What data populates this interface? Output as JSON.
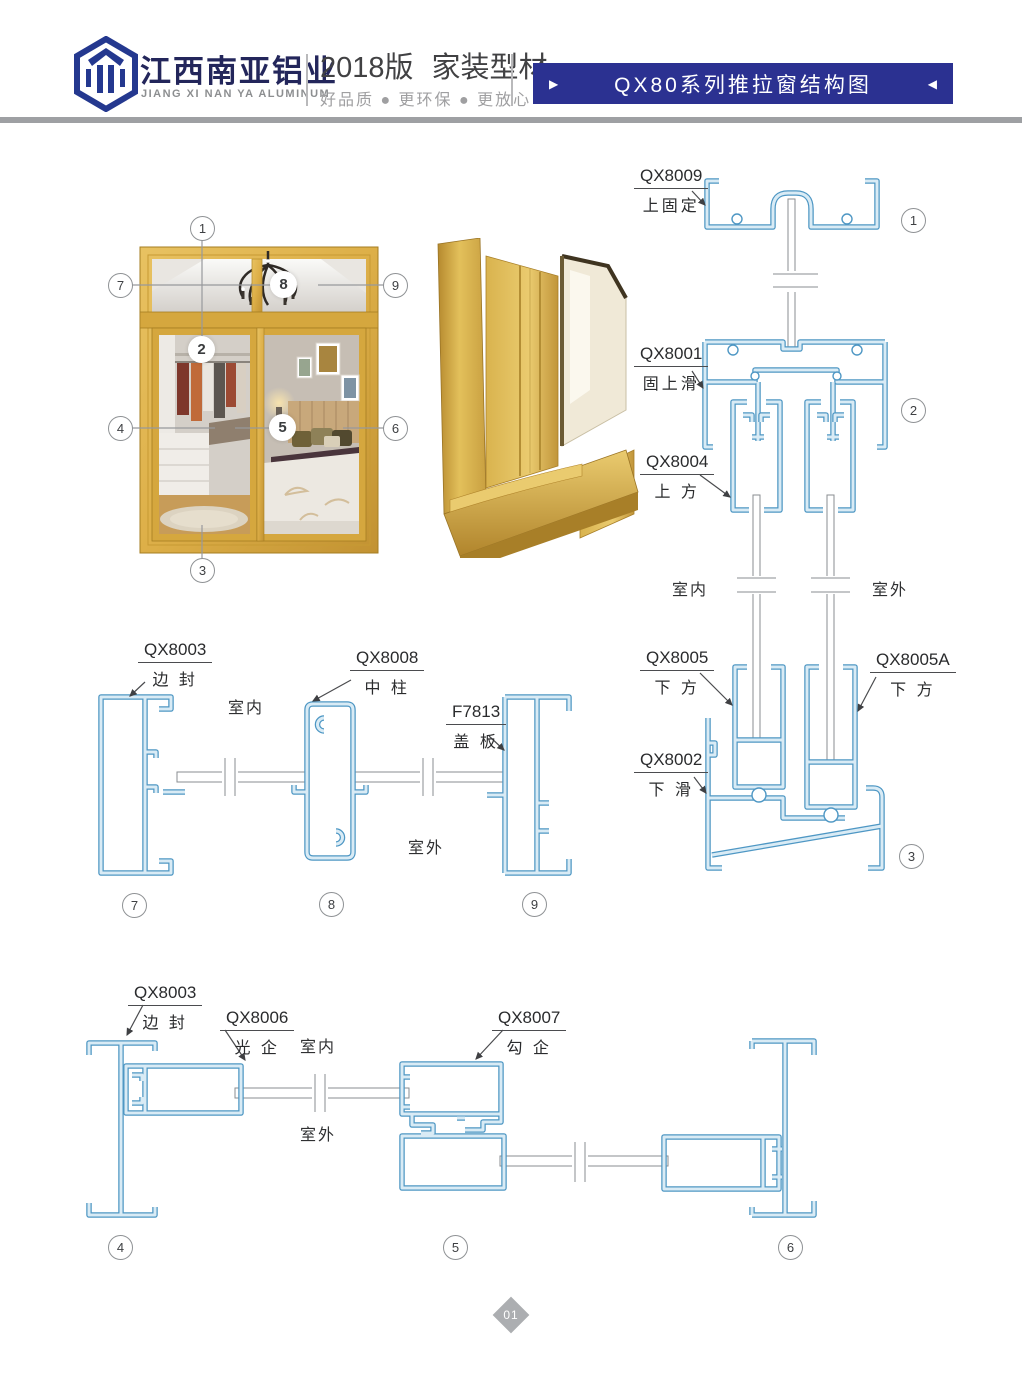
{
  "header": {
    "company_zh": "江西南亚铝业",
    "company_en": "JIANG XI NAN YA ALUMINUM",
    "edition": "2018版",
    "series": "家装型材",
    "tagline": "好品质 ● 更环保 ● 更放心",
    "banner": {
      "title": "QX80系列推拉窗结构图",
      "left_arrow": "▶",
      "right_arrow": "◀"
    }
  },
  "labels": {
    "qx8009": {
      "code": "QX8009",
      "name": "上固定"
    },
    "qx8001": {
      "code": "QX8001",
      "name": "固上滑"
    },
    "qx8004": {
      "code": "QX8004",
      "name": "上 方"
    },
    "qx8005": {
      "code": "QX8005",
      "name": "下 方"
    },
    "qx8005a": {
      "code": "QX8005A",
      "name": "下 方"
    },
    "qx8002": {
      "code": "QX8002",
      "name": "下 滑"
    },
    "qx8003": {
      "code": "QX8003",
      "name": "边 封"
    },
    "qx8008": {
      "code": "QX8008",
      "name": "中 柱"
    },
    "f7813": {
      "code": "F7813",
      "name": "盖 板"
    },
    "qx8006": {
      "code": "QX8006",
      "name": "光 企"
    },
    "qx8007": {
      "code": "QX8007",
      "name": "勾 企"
    }
  },
  "rooms": {
    "inside": "室内",
    "outside": "室外"
  },
  "callouts": {
    "c1": "1",
    "c2": "2",
    "c3": "3",
    "c4": "4",
    "c5": "5",
    "c6": "6",
    "c7": "7",
    "c8": "8",
    "c9": "9"
  },
  "page_number": "01",
  "colors": {
    "banner_blue": "#2B3191",
    "logo_navy": "#24388F",
    "profile_blue": "#4E97C4",
    "profile_fill": "#D9EBF5",
    "gold": "#DDAF48",
    "gray_bar": "#9EA0A3"
  }
}
